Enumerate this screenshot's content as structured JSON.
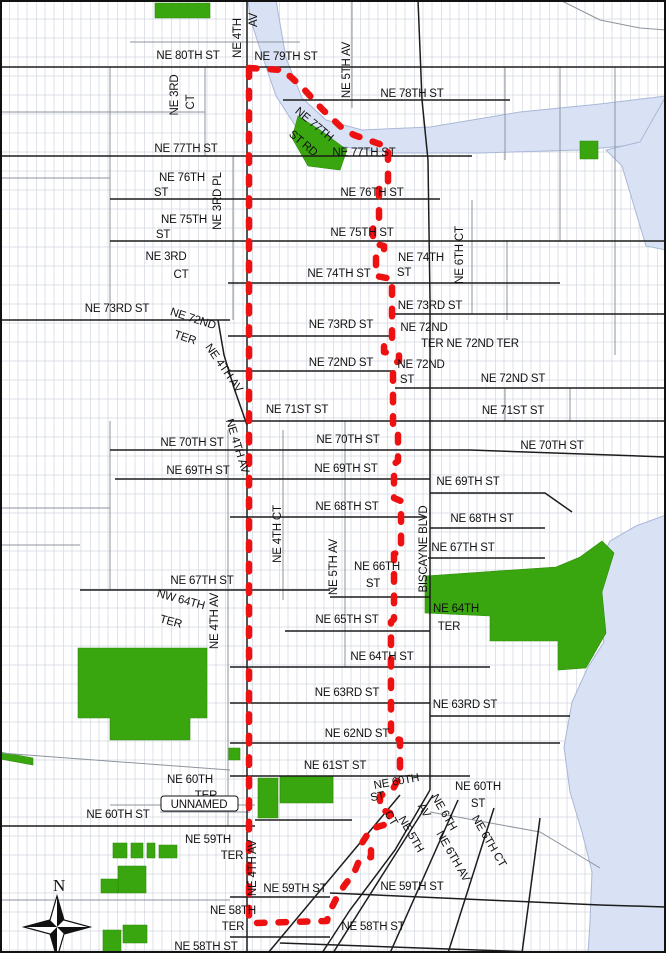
{
  "colors": {
    "background": "#ffffff",
    "water": "#d9e2f4",
    "water_edge": "#a9b8d8",
    "park": "#3aa60f",
    "park_edge": "#2c8a0a",
    "boundary_red": "#ee1111",
    "street_major": "#1c1c1c",
    "street_minor": "#8d939c",
    "parcel": "#c9cfdb",
    "label": "#111111",
    "frame": "#111111"
  },
  "north_arrow": {
    "label": "N"
  },
  "labels": [
    {
      "t": "NE 80TH ST",
      "x": 188,
      "y": 59
    },
    {
      "t": "NE 4TH",
      "x": 241,
      "y": 38,
      "r": -90
    },
    {
      "t": "AV",
      "x": 257,
      "y": 20,
      "r": -90
    },
    {
      "t": "NE 79TH ST",
      "x": 286,
      "y": 60
    },
    {
      "t": "NE 5TH AV",
      "x": 350,
      "y": 70,
      "r": -90
    },
    {
      "t": "NE 78TH ST",
      "x": 412,
      "y": 97
    },
    {
      "t": "NE 3RD",
      "x": 178,
      "y": 95,
      "r": -90
    },
    {
      "t": "CT",
      "x": 194,
      "y": 102,
      "r": -90
    },
    {
      "t": "NE 77TH",
      "x": 312,
      "y": 127,
      "r": 40
    },
    {
      "t": "ST RD",
      "x": 301,
      "y": 146,
      "r": 40
    },
    {
      "t": "NE 77TH ST",
      "x": 186,
      "y": 152
    },
    {
      "t": "NE 77TH ST",
      "x": 364,
      "y": 156
    },
    {
      "t": "NE 76TH",
      "x": 182,
      "y": 181
    },
    {
      "t": "ST",
      "x": 161,
      "y": 196
    },
    {
      "t": "NE 76TH ST",
      "x": 372,
      "y": 196
    },
    {
      "t": "NE 75TH",
      "x": 184,
      "y": 223
    },
    {
      "t": "ST",
      "x": 163,
      "y": 238
    },
    {
      "t": "NE 75TH ST",
      "x": 362,
      "y": 236
    },
    {
      "t": "NE 3RD PL",
      "x": 221,
      "y": 201,
      "r": -90
    },
    {
      "t": "NE 74TH",
      "x": 421,
      "y": 261
    },
    {
      "t": "ST",
      "x": 404,
      "y": 276
    },
    {
      "t": "NE 6TH CT",
      "x": 463,
      "y": 255,
      "r": -90
    },
    {
      "t": "NE 74TH ST",
      "x": 339,
      "y": 277
    },
    {
      "t": "NE 3RD",
      "x": 166,
      "y": 260
    },
    {
      "t": "CT",
      "x": 181,
      "y": 278
    },
    {
      "t": "NE 73RD ST",
      "x": 117,
      "y": 312
    },
    {
      "t": "NE 73RD ST",
      "x": 430,
      "y": 309
    },
    {
      "t": "NE 73RD ST",
      "x": 341,
      "y": 328
    },
    {
      "t": "NE 72ND",
      "x": 192,
      "y": 322,
      "r": 18
    },
    {
      "t": "TER",
      "x": 184,
      "y": 341,
      "r": 18
    },
    {
      "t": "NE 72ND",
      "x": 424,
      "y": 331
    },
    {
      "t": "TER NE 72ND TER",
      "x": 470,
      "y": 347
    },
    {
      "t": "NE 72ND ST",
      "x": 341,
      "y": 366
    },
    {
      "t": "NE 72ND",
      "x": 421,
      "y": 368
    },
    {
      "t": "ST",
      "x": 407,
      "y": 383
    },
    {
      "t": "NE 72ND ST",
      "x": 513,
      "y": 382
    },
    {
      "t": "NE 71ST ST",
      "x": 297,
      "y": 413
    },
    {
      "t": "NE 71ST ST",
      "x": 513,
      "y": 414
    },
    {
      "t": "NE 4TH AV",
      "x": 221,
      "y": 370,
      "r": 55
    },
    {
      "t": "NE 4TH AV",
      "x": 234,
      "y": 447,
      "r": 73
    },
    {
      "t": "NE 70TH ST",
      "x": 192,
      "y": 446
    },
    {
      "t": "NE 70TH ST",
      "x": 348,
      "y": 443
    },
    {
      "t": "NE 70TH ST",
      "x": 552,
      "y": 449
    },
    {
      "t": "NE 69TH ST",
      "x": 198,
      "y": 474
    },
    {
      "t": "NE 69TH ST",
      "x": 346,
      "y": 472
    },
    {
      "t": "NE 69TH ST",
      "x": 468,
      "y": 485
    },
    {
      "t": "NE 68TH ST",
      "x": 347,
      "y": 510
    },
    {
      "t": "NE 68TH ST",
      "x": 482,
      "y": 522
    },
    {
      "t": "NE 4TH CT",
      "x": 281,
      "y": 534,
      "r": -90
    },
    {
      "t": "NE 5TH AV",
      "x": 337,
      "y": 567,
      "r": -90
    },
    {
      "t": "BISCAYNE BLVD",
      "x": 427,
      "y": 549,
      "r": -90
    },
    {
      "t": "NE 67TH ST",
      "x": 202,
      "y": 584
    },
    {
      "t": "NE 67TH ST",
      "x": 463,
      "y": 551
    },
    {
      "t": "NE 66TH",
      "x": 377,
      "y": 570
    },
    {
      "t": "ST",
      "x": 373,
      "y": 587
    },
    {
      "t": "NW 64TH",
      "x": 180,
      "y": 603,
      "r": 15
    },
    {
      "t": "TER",
      "x": 170,
      "y": 625,
      "r": 15
    },
    {
      "t": "NE 4TH AV",
      "x": 218,
      "y": 621,
      "r": -90
    },
    {
      "t": "NE 65TH ST",
      "x": 347,
      "y": 623
    },
    {
      "t": "NE 64TH",
      "x": 456,
      "y": 612
    },
    {
      "t": "TER",
      "x": 449,
      "y": 630
    },
    {
      "t": "NE 64TH ST",
      "x": 382,
      "y": 660
    },
    {
      "t": "NE 63RD ST",
      "x": 347,
      "y": 696
    },
    {
      "t": "NE 63RD ST",
      "x": 465,
      "y": 708
    },
    {
      "t": "NE 62ND ST",
      "x": 357,
      "y": 737
    },
    {
      "t": "NE 61ST ST",
      "x": 335,
      "y": 769
    },
    {
      "t": "NE 60TH",
      "x": 190,
      "y": 783
    },
    {
      "t": "TER",
      "x": 206,
      "y": 799
    },
    {
      "t": "NE 60TH ST",
      "x": 118,
      "y": 818
    },
    {
      "t": "NE 60TH",
      "x": 397,
      "y": 785,
      "r": -10
    },
    {
      "t": "ST",
      "x": 378,
      "y": 800,
      "r": -10
    },
    {
      "t": "NE 60TH",
      "x": 478,
      "y": 790
    },
    {
      "t": "ST",
      "x": 478,
      "y": 807
    },
    {
      "t": "CT",
      "x": 388,
      "y": 820,
      "r": 60
    },
    {
      "t": "NE 5TH",
      "x": 408,
      "y": 836,
      "r": 60
    },
    {
      "t": "AV",
      "x": 421,
      "y": 812,
      "r": 60
    },
    {
      "t": "NE 6TH",
      "x": 441,
      "y": 814,
      "r": 60
    },
    {
      "t": "NE 6TH AV",
      "x": 450,
      "y": 858,
      "r": 60
    },
    {
      "t": "NE 6TH CT",
      "x": 486,
      "y": 843,
      "r": 60
    },
    {
      "t": "NE 59TH",
      "x": 208,
      "y": 843
    },
    {
      "t": "TER",
      "x": 232,
      "y": 859
    },
    {
      "t": "NE 4TH AV",
      "x": 256,
      "y": 868,
      "r": -90
    },
    {
      "t": "NE 59TH ST",
      "x": 295,
      "y": 892
    },
    {
      "t": "NE 59TH ST",
      "x": 412,
      "y": 890
    },
    {
      "t": "NE 58TH",
      "x": 233,
      "y": 914
    },
    {
      "t": "TER",
      "x": 233,
      "y": 930
    },
    {
      "t": "NE 58TH ST",
      "x": 373,
      "y": 930
    },
    {
      "t": "NE 58TH ST",
      "x": 206,
      "y": 950
    },
    {
      "t": "UNNAMED",
      "x": 199,
      "y": 808,
      "box": [
        161,
        796,
        77,
        15
      ]
    }
  ],
  "geometry": {
    "streets_major": [
      "0,67 666,67",
      "283,100 510,100",
      "0,156 472,156",
      "110,199 440,199",
      "110,241 666,241",
      "228,283 560,283",
      "0,320 230,320",
      "228,336 392,336",
      "392,314 666,314",
      "228,371 395,371",
      "395,388 666,388",
      "228,421 666,421",
      "110,450 470,450 666,457",
      "115,479 430,479",
      "430,493 545,493 572,512",
      "230,517 425,517",
      "430,528 545,528",
      "80,590 330,590",
      "428,558 545,558",
      "330,597 430,597",
      "285,631 430,631",
      "230,667 490,667",
      "230,703 430,703",
      "430,716 570,716",
      "230,743 560,743",
      "230,776 470,776",
      "0,826 255,826",
      "255,820 352,820",
      "230,897 330,897",
      "330,893 600,905 666,907",
      "230,937 330,937",
      "280,943 560,953",
      "247,0 247,953",
      "418,0 422,100 428,160 430,300 430,790",
      "430,790 395,850 350,910 322,953",
      "218,320 224,355 234,388 247,425",
      "400,795 268,953",
      "433,795 333,953",
      "458,800 390,953",
      "494,808 448,953",
      "540,818 522,953"
    ],
    "streets_minor": [
      "130,42 300,42",
      "205,67 205,156",
      "233,156 233,320",
      "352,0 352,108",
      "505,67 505,160",
      "560,67 560,241",
      "615,67 615,241",
      "560,0 600,20 640,28 666,30",
      "0,112 205,112",
      "0,178 110,178",
      "110,67 110,320",
      "472,200 472,314",
      "507,240 507,320",
      "615,241 615,355",
      "283,430 283,600",
      "345,421 345,667",
      "228,430 228,826",
      "110,421 110,590",
      "0,508 110,508",
      "0,545 80,545",
      "505,388 505,421",
      "570,388 570,421",
      "0,753 230,770",
      "0,900 230,900",
      "430,812 540,832 600,868",
      "160,812 250,812",
      "110,805 255,805"
    ],
    "water": [
      "248,0 276,0 286,58 302,98 326,120 362,130 430,127 520,112 600,104 666,96 666,142 580,150 480,153 392,153 336,146 298,130 276,96 262,55 250,18",
      "666,96 666,250 646,246 634,206 622,166 606,150 640,142",
      "666,515 636,526 610,541 598,566 596,602 604,642 588,667 572,702 564,747 570,792 582,832 592,872 590,922 588,953 666,953"
    ],
    "parks": [
      "155,3 210,3 210,18 155,18",
      "298,116 320,130 347,150 340,170 308,166 292,138",
      "580,141 598,141 598,159 580,159",
      "425,576 556,567 580,557 602,541 614,553 602,592 606,633 586,668 558,670 558,641 490,641 490,616 425,613",
      "78,648 207,648 207,718 190,718 190,740 110,740 110,718 78,718",
      "228,748 240,748 240,760 228,760",
      "258,778 278,778 278,818 258,818",
      "280,776 333,776 333,803 280,803",
      "113,843 127,843 127,858 113,858",
      "131,843 143,843 143,858 131,858",
      "147,843 155,843 155,858 147,858",
      "159,845 177,845 177,858 159,858",
      "118,866 146,866 146,893 118,893",
      "101,879 118,879 118,893 101,893",
      "103,930 121,930 121,952 103,952",
      "123,925 147,925 147,943 123,943",
      "0,752 33,758 33,765 0,759"
    ],
    "boundary": "249,68 283,70 302,87 322,109 341,127 354,135 388,147 388,186 379,189 379,218 373,222 373,243 384,246 384,252 376,255 376,276 392,279 392,338 384,341 384,352 399,355 399,361 393,364 393,430 398,433 398,461 394,464 394,498 401,501 401,551 394,554 394,619 391,622 391,737 400,740 400,776 393,789 380,796 380,809 390,813 390,823 371,829 362,843 371,847 371,857 359,861 354,873 344,886 336,899 329,913 327,921 255,923 249,921"
  }
}
